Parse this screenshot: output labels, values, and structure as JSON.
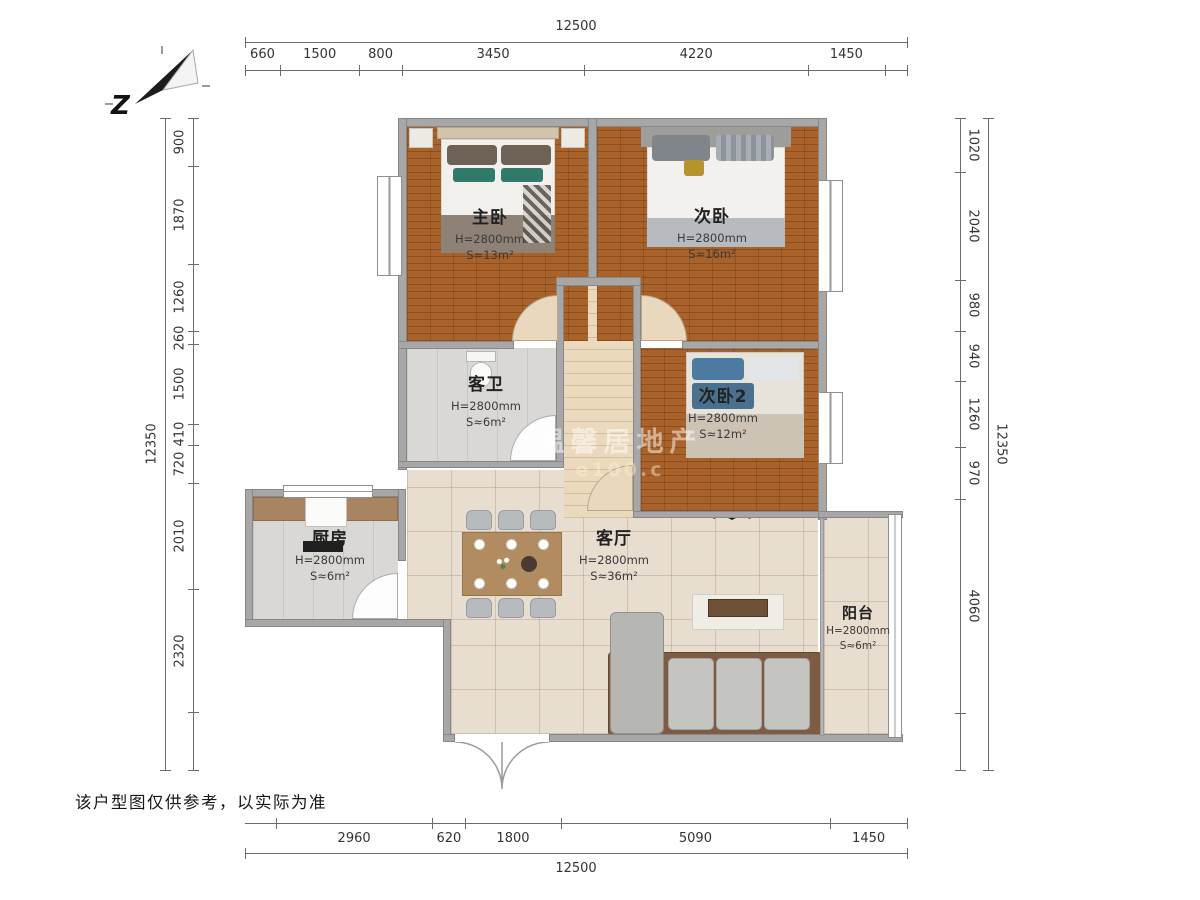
{
  "compass": {
    "label": "Z"
  },
  "watermark": {
    "line1": "温馨居地产",
    "line2": "e100.c"
  },
  "disclaimer": "该户型图仅供参考，以实际为准",
  "rooms": [
    {
      "name": "主卧",
      "height": "H=2800mm",
      "area": "S≈13m²"
    },
    {
      "name": "次卧",
      "height": "H=2800mm",
      "area": "S≈16m²"
    },
    {
      "name": "客卫",
      "height": "H=2800mm",
      "area": "S≈6m²"
    },
    {
      "name": "次卧2",
      "height": "H=2800mm",
      "area": "S≈12m²"
    },
    {
      "name": "厨房",
      "height": "H=2800mm",
      "area": "S≈6m²"
    },
    {
      "name": "客厅",
      "height": "H=2800mm",
      "area": "S≈36m²"
    },
    {
      "name": "阳台",
      "height": "H=2800mm",
      "area": "S≈6m²"
    }
  ],
  "dimensions": {
    "top": {
      "total": "12500",
      "segments": [
        "660",
        "1500",
        "800",
        "3450",
        "4220",
        "1450"
      ],
      "filler": "end"
    },
    "bottom": {
      "total": "12500",
      "segments": [
        "2960",
        "620",
        "1800",
        "5090",
        "1450"
      ],
      "filler": "start"
    },
    "left": {
      "total": "12350",
      "segments": [
        "900",
        "1870",
        "1260",
        "260",
        "1500",
        "410",
        "720",
        "2010",
        "2320"
      ],
      "filler": "end"
    },
    "right": {
      "total": "12350",
      "segments": [
        "1020",
        "2040",
        "980",
        "940",
        "1260",
        "970",
        "4060"
      ],
      "filler": "end"
    }
  },
  "colors": {
    "wood_floor": "#a8622a",
    "warm_tile": "#e7decf",
    "gray_tile": "#d9d8d5",
    "wall": "#a7a7a7",
    "accent_green": "#2f7a68",
    "accent_blue": "#4c7ba2"
  }
}
